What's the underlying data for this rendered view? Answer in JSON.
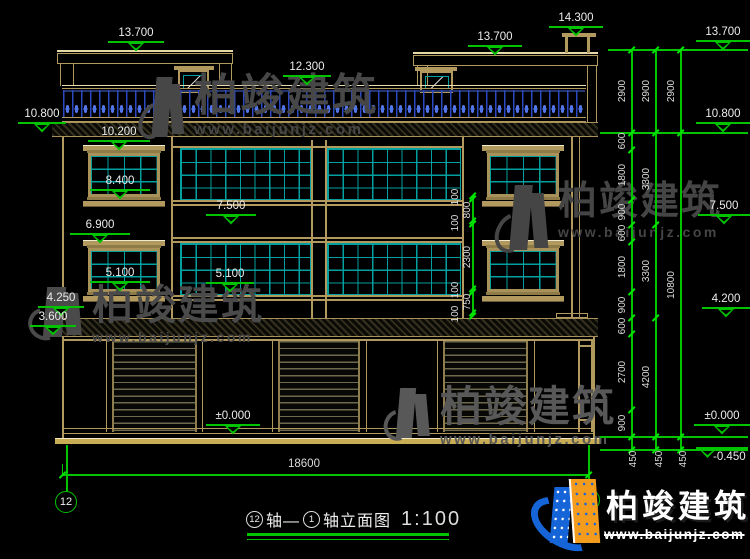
{
  "brand": {
    "name": "柏竣建筑",
    "url": "www.baijunjz.com"
  },
  "title": {
    "axis_from": "12",
    "axis_label_1": "轴—",
    "axis_to": "1",
    "axis_label_2": "轴立面图",
    "scale": "1:100"
  },
  "axes": {
    "left": "12",
    "right": "1"
  },
  "levels": {
    "roof_left": "13.700",
    "stair_roof": "14.300",
    "roof_right": "13.700",
    "parapet": "12.300",
    "main_roof": "10.800",
    "win3_head": "10.200",
    "win3_sill": "8.400",
    "band3": "7.500",
    "win2_head": "6.900",
    "win2_sill": "5.100",
    "band2": "5.100",
    "ledge_left": "4.250",
    "beam_left": "3.600",
    "ground": "±0.000",
    "right": {
      "roof": "13.700",
      "main_roof": "10.800",
      "band3": "7.500",
      "ledge": "4.200",
      "ground": "±0.000",
      "foundation": "-0.450"
    }
  },
  "dims": {
    "chain_inner": [
      "2900",
      "600",
      "1800",
      "900",
      "600",
      "1800",
      "900",
      "600",
      "2700",
      "900",
      "450"
    ],
    "chain_mid": [
      "2900",
      "3300",
      "3300",
      "4200",
      "450"
    ],
    "chain_outer": [
      "2900",
      "10800",
      "450"
    ],
    "window_chain": [
      "100",
      "800",
      "100",
      "2300",
      "100",
      "750",
      "100"
    ],
    "total_width": "18600"
  }
}
